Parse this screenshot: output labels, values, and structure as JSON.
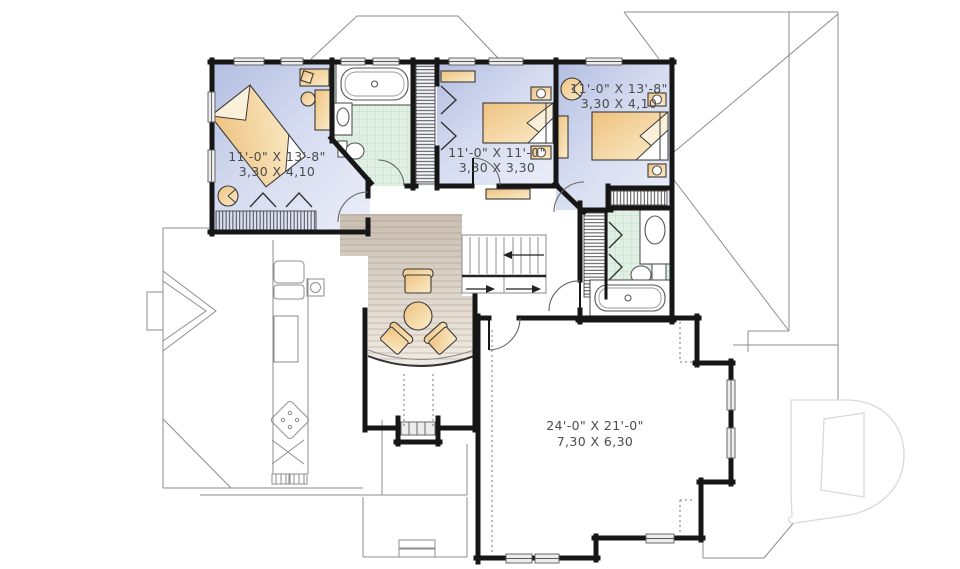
{
  "floor_plan": {
    "labels": [
      {
        "id": "bedroom-1",
        "imperial": "11'-0\" X 13'-8\"",
        "metric": "3,30 X 4,10"
      },
      {
        "id": "bedroom-2",
        "imperial": "11'-0\" X 11'-0\"",
        "metric": "3,30 X 3,30"
      },
      {
        "id": "bedroom-3",
        "imperial": "11'-0\" X 13'-8\"",
        "metric": "3,30 X 4,10"
      },
      {
        "id": "bonus-room",
        "imperial": "24'-0\" X 21'-0\"",
        "metric": "7,30 X 6,30"
      }
    ]
  },
  "watermark": {
    "icon": "d-logo",
    "letter": "D"
  },
  "colors": {
    "wall": "#161616",
    "thin": "#8d8d8d",
    "room_a": "#b2bee1",
    "room_b": "#e9ecf8",
    "furn_a": "#eec27f",
    "furn_b": "#fbeccb",
    "tile": "#e0efe4",
    "tile_line": "#c5dccb",
    "wood_a": "#c9beb1",
    "wood_b": "#f1ebe3",
    "label": "#4c4c4c",
    "fixture_line": "#555555",
    "logo": "#d9d9d9"
  }
}
